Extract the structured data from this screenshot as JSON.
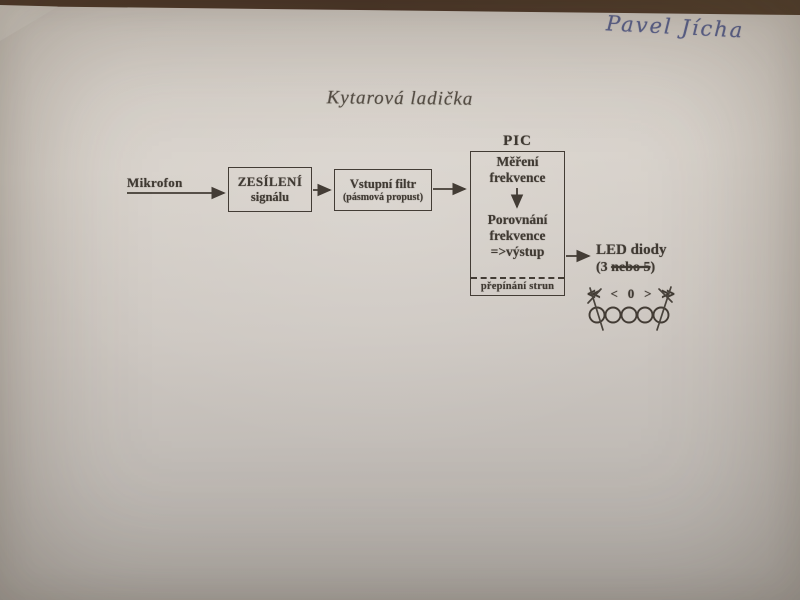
{
  "photo": {
    "handwriting": "Pavel Jícha",
    "title": "Kytarová ladička"
  },
  "diagram": {
    "mikrofon_label": "Mikrofon",
    "box_amplify": {
      "line1": "ZESÍLENÍ",
      "line2": "signálu"
    },
    "box_filter": {
      "line1": "Vstupní filtr",
      "line2": "(pásmová propust)"
    },
    "pic_label": "PIC",
    "pic_box": {
      "step1_line1": "Měření",
      "step1_line2": "frekvence",
      "step2_line1": "Porovnání",
      "step2_line2": "frekvence",
      "step2_line3": "=>výstup",
      "footer": "přepínání strun"
    },
    "led_label": "LED diody",
    "led_count_prefix": "(3 ",
    "led_count_struck": "nebo 5",
    "led_count_suffix": ")",
    "symbols": [
      "≪",
      "<",
      "0",
      ">",
      "≫"
    ],
    "led_circle_count": 5
  },
  "colors": {
    "ink": "#433c35",
    "pen": "#5a628f",
    "paper": "#cfc9c2"
  }
}
